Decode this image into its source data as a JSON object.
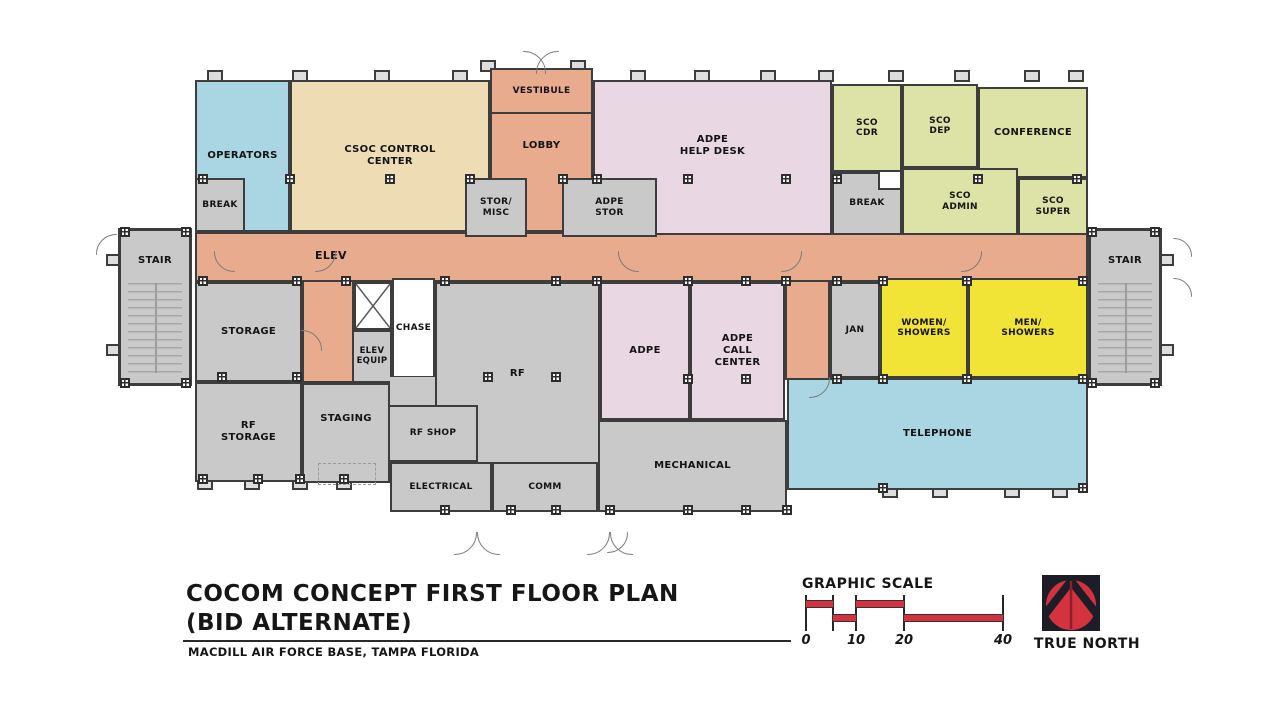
{
  "palette": {
    "corridor": "#e8ab8e",
    "blue_room": "#a9d6e2",
    "tan_room": "#eedcb5",
    "pink_room": "#e9d7e3",
    "green_room": "#dde3a6",
    "gray_room": "#c9c9c9",
    "yellow_room": "#f1e437",
    "white_room": "#ffffff",
    "wall": "#3d3d3d",
    "accent_red": "#d5323f"
  },
  "plan": {
    "rooms": {
      "operators": {
        "label": "OPERATORS"
      },
      "break_west": {
        "label": "BREAK"
      },
      "csoc": {
        "label": "CSOC CONTROL\nCENTER"
      },
      "vestibule": {
        "label": "VESTIBULE"
      },
      "lobby": {
        "label": "LOBBY"
      },
      "stor_misc": {
        "label": "STOR/\nMISC"
      },
      "adpe_stor": {
        "label": "ADPE\nSTOR"
      },
      "adpe_help_desk": {
        "label": "ADPE\nHELP DESK"
      },
      "sco_cdr": {
        "label": "SCO\nCDR"
      },
      "sco_dep": {
        "label": "SCO\nDEP"
      },
      "conference": {
        "label": "CONFERENCE"
      },
      "break_east": {
        "label": "BREAK"
      },
      "sco_admin": {
        "label": "SCO\nADMIN"
      },
      "sco_super": {
        "label": "SCO\nSUPER"
      },
      "corridor": {
        "label": "ELEV"
      },
      "stair_west": {
        "label": "STAIR"
      },
      "stair_east": {
        "label": "STAIR"
      },
      "storage": {
        "label": "STORAGE"
      },
      "chase": {
        "label": "CHASE"
      },
      "elev_equip": {
        "label": "ELEV\nEQUIP"
      },
      "rf": {
        "label": "RF"
      },
      "adpe": {
        "label": "ADPE"
      },
      "adpe_call_center": {
        "label": "ADPE\nCALL\nCENTER"
      },
      "jan": {
        "label": "JAN"
      },
      "women_showers": {
        "label": "WOMEN/\nSHOWERS"
      },
      "men_showers": {
        "label": "MEN/\nSHOWERS"
      },
      "rf_storage": {
        "label": "RF\nSTORAGE"
      },
      "staging": {
        "label": "STAGING"
      },
      "rf_shop": {
        "label": "RF SHOP"
      },
      "electrical": {
        "label": "ELECTRICAL"
      },
      "comm": {
        "label": "COMM"
      },
      "mechanical": {
        "label": "MECHANICAL"
      },
      "telephone": {
        "label": "TELEPHONE"
      }
    }
  },
  "title_block": {
    "title": "COCOM CONCEPT FIRST FLOOR PLAN",
    "subtitle": "(BID ALTERNATE)",
    "location": "MACDILL AIR FORCE BASE, TAMPA FLORIDA"
  },
  "graphic_scale": {
    "title": "GRAPHIC SCALE",
    "tick_labels": [
      "0",
      "10",
      "20",
      "40"
    ]
  },
  "true_north": {
    "label": "TRUE NORTH"
  }
}
